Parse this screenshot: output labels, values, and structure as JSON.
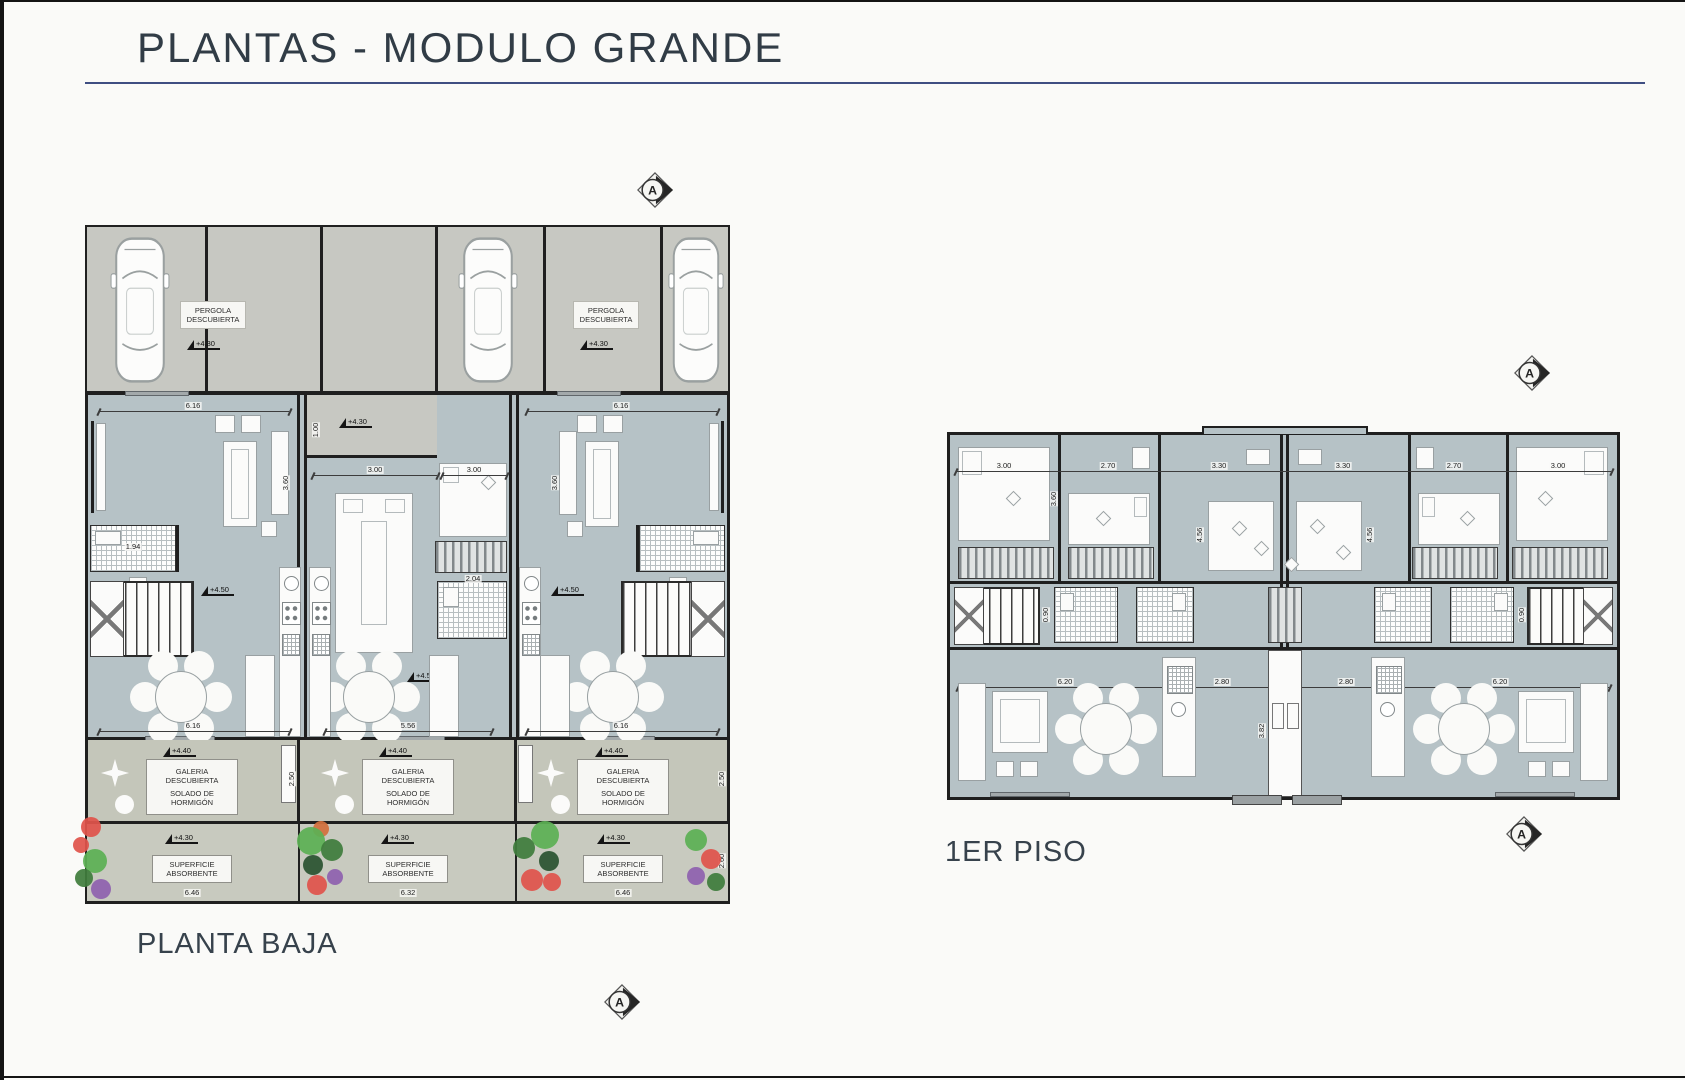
{
  "page": {
    "title": "PLANTAS - MODULO GRANDE"
  },
  "markers": {
    "section_letter": "A"
  },
  "levels": {
    "l430": "+4.30",
    "l440": "+4.40",
    "l450": "+4.50"
  },
  "colors": {
    "accent_rule": "#3F4E82",
    "floor_interior": "#B6C2C6",
    "floor_outdoor": "#C7C8C2",
    "yard_galeria": "#C4C6BA",
    "yard_absorbent": "#C8CABF",
    "wall": "#1F1F1F"
  },
  "plan_ground": {
    "title": "PLANTA BAJA",
    "pergola_label": {
      "l1": "PERGOLA",
      "l2": "DESCUBIERTA"
    },
    "galeria_label": {
      "l1": "GALERIA",
      "l2": "DESCUBIERTA",
      "l3": "SOLADO DE",
      "l4": "HORMIGÓN"
    },
    "superficie_label": {
      "l1": "SUPERFICIE",
      "l2": "ABSORBENTE"
    },
    "dims": {
      "d616": "6.16",
      "d300": "3.00",
      "d556": "5.56",
      "d646": "6.46",
      "d632": "6.32",
      "d194": "1.94",
      "d204": "2.04",
      "d360": "3.60",
      "d100": "1.00",
      "d250": "2.50",
      "d260": "2.60"
    }
  },
  "plan_first": {
    "title": "1ER PISO",
    "dims": {
      "d300": "3.00",
      "d270": "2.70",
      "d330": "3.30",
      "d620": "6.20",
      "d280": "2.80",
      "d456": "4.56",
      "d382": "3.82",
      "d090": "0.90",
      "d360": "3.60"
    }
  }
}
